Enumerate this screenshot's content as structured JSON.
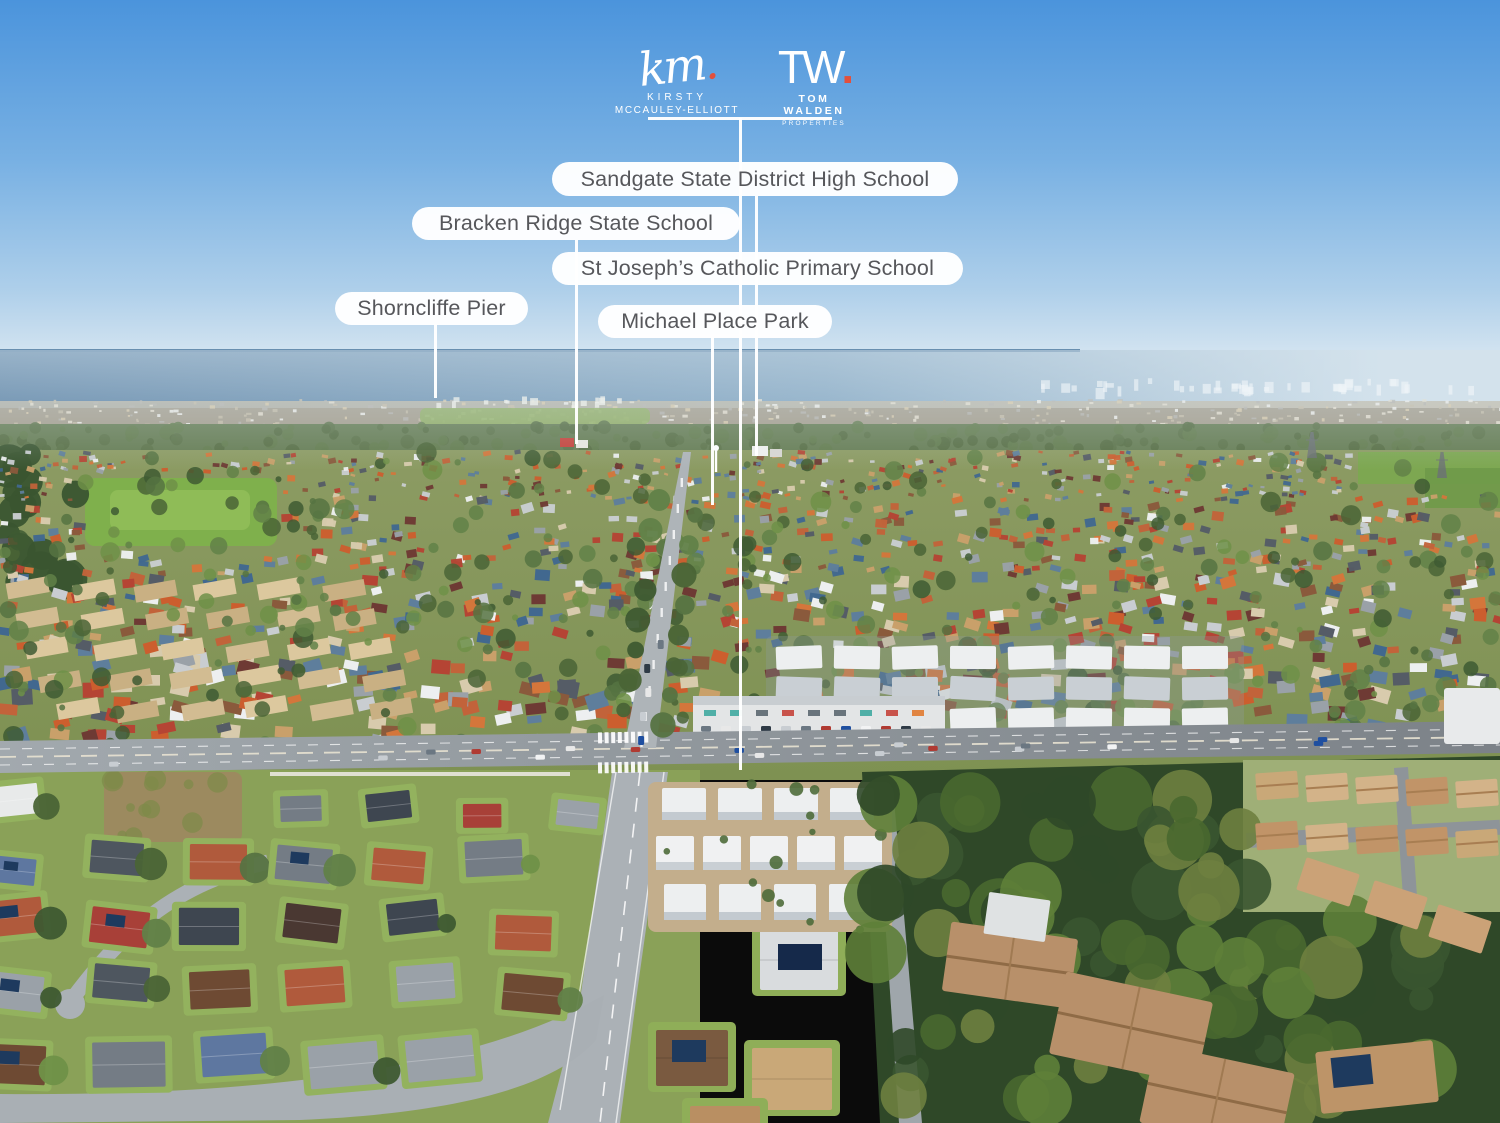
{
  "branding": {
    "km": {
      "script": "km",
      "dot": ".",
      "line1": "KIRSTY",
      "line2": "MCCAULEY-ELLIOTT"
    },
    "tw": {
      "mark": "TW",
      "dot": ".",
      "line1": "TOM WALDEN",
      "line2": "PROPERTIES"
    },
    "accent": "#E2503C"
  },
  "annotations": [
    {
      "id": "sandgate",
      "label": "Sandgate State District High School"
    },
    {
      "id": "bracken",
      "label": "Bracken Ridge State School"
    },
    {
      "id": "stjoseph",
      "label": "St Joseph’s Catholic Primary School"
    },
    {
      "id": "shorncliffe",
      "label": "Shorncliffe Pier"
    },
    {
      "id": "michael",
      "label": "Michael Place Park"
    }
  ],
  "scene": {
    "colors": {
      "sky_top": "#4B94DC",
      "sky_mid": "#79B1E3",
      "sky_low": "#AECFEA",
      "sky_horizon": "#D7E6F1",
      "ocean": "#527A9E",
      "ocean_light": "#7FA3BF",
      "haze": "#D3E2EC",
      "shore": "#BFB7A3",
      "treeline": "#667D54",
      "suburb_top": "#8C9B63",
      "suburb_bot": "#7E9152",
      "park": "#7FB04C",
      "park_light": "#8FBC57",
      "field": "#7BA850",
      "road": "#A2A9AE",
      "road_dark": "#7C8288",
      "lane": "#FFFFFF",
      "median": "#E8E2D2",
      "lawn": "#8AA158",
      "dirt": "#9C8A5F",
      "forest": "#2F4828",
      "forest_mid": "#3A5530",
      "forest_hi": "#49682F",
      "olive": "#6E7F3F",
      "white_roof": "#EDEFF0",
      "gray_roof": "#C9CFD4",
      "slate_roof": "#3E4650",
      "tan_roof": "#C19468",
      "tan_light": "#D2BC92",
      "tan_dark": "#A87E52",
      "drive": "#C3AE8C",
      "wall": "#E9E7E0",
      "pill_bg": "#FFFFFF",
      "pill_text": "#56575B",
      "accent": "#E2503C"
    },
    "mid_roof_palette": [
      "#C2633A",
      "#CC5E2E",
      "#B54434",
      "#8A5A3C",
      "#C9A06A",
      "#D8CBAD",
      "#C9CDD1",
      "#EDEFF0",
      "#9AA1A8",
      "#555C66",
      "#5E7E9C",
      "#41688F",
      "#6E3A34",
      "#D4763B"
    ],
    "fg_roof_palette": [
      "#4E565F",
      "#747C85",
      "#6E4A33",
      "#4A3832",
      "#A84038",
      "#B05A3C",
      "#E8EAEA",
      "#9AA1A8",
      "#3E4650",
      "#5E77A0"
    ],
    "tree_palette": [
      "#4A6436",
      "#567342",
      "#618148",
      "#6F9148",
      "#3E5A32"
    ],
    "car_palette": [
      "#F2F3F4",
      "#2E3A46",
      "#B03A32",
      "#C8CDD2",
      "#6B7782",
      "#E8E8E8",
      "#1F4FA0"
    ]
  }
}
